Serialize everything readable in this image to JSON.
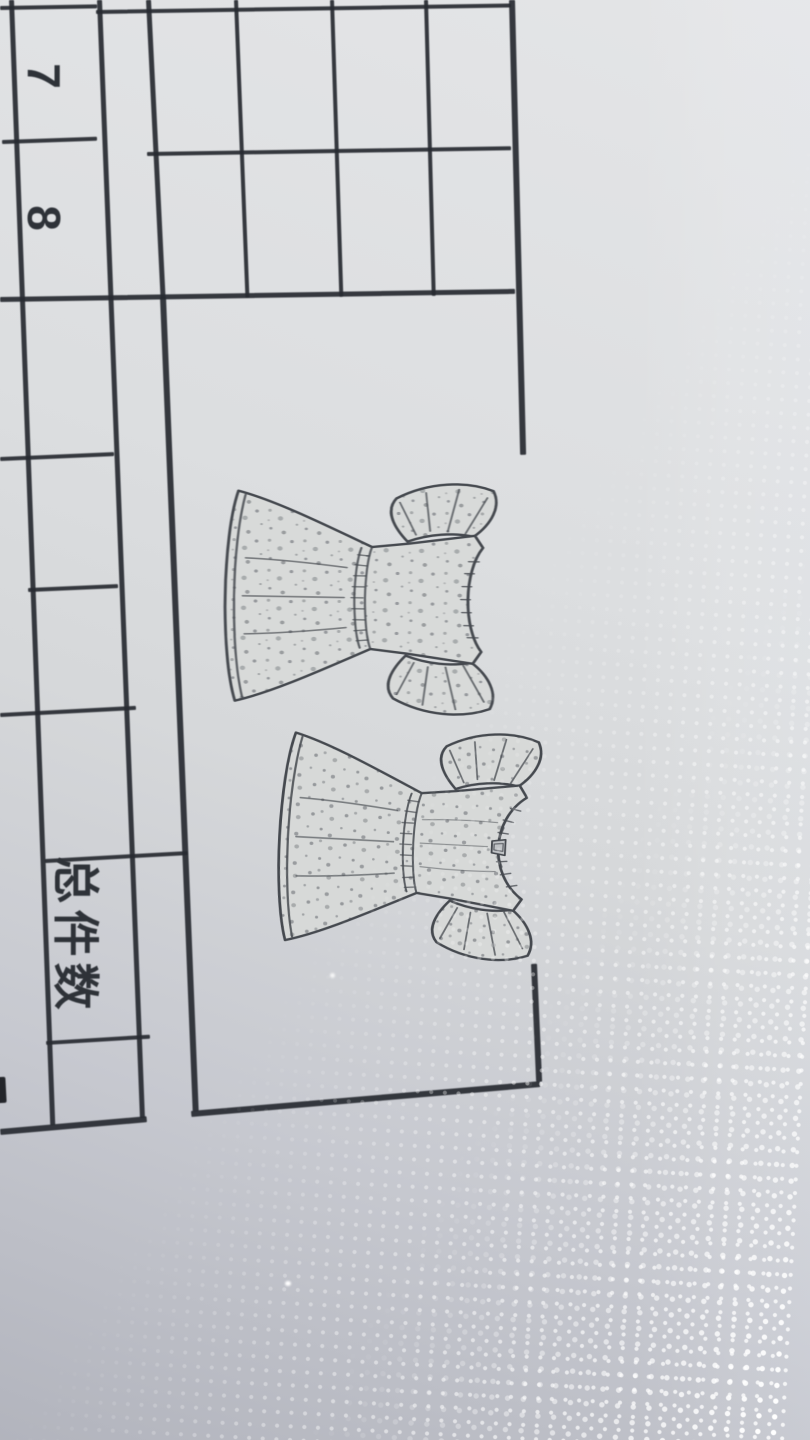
{
  "table": {
    "size_column": {
      "cells": [
        "7",
        "8"
      ]
    },
    "total_label": "总件数"
  },
  "sketch_panel": {
    "sketches": [
      {
        "name": "dress-back-view-sketch"
      },
      {
        "name": "dress-front-view-sketch"
      }
    ]
  },
  "colors": {
    "paper_light": "#e4e5e7",
    "paper_shadow": "#b2b4bd",
    "table_rule": "#282b31",
    "sketch_stroke": "#45494f",
    "fabric_fill": "#d8dad9",
    "halftone_dot": "#ffffff"
  }
}
